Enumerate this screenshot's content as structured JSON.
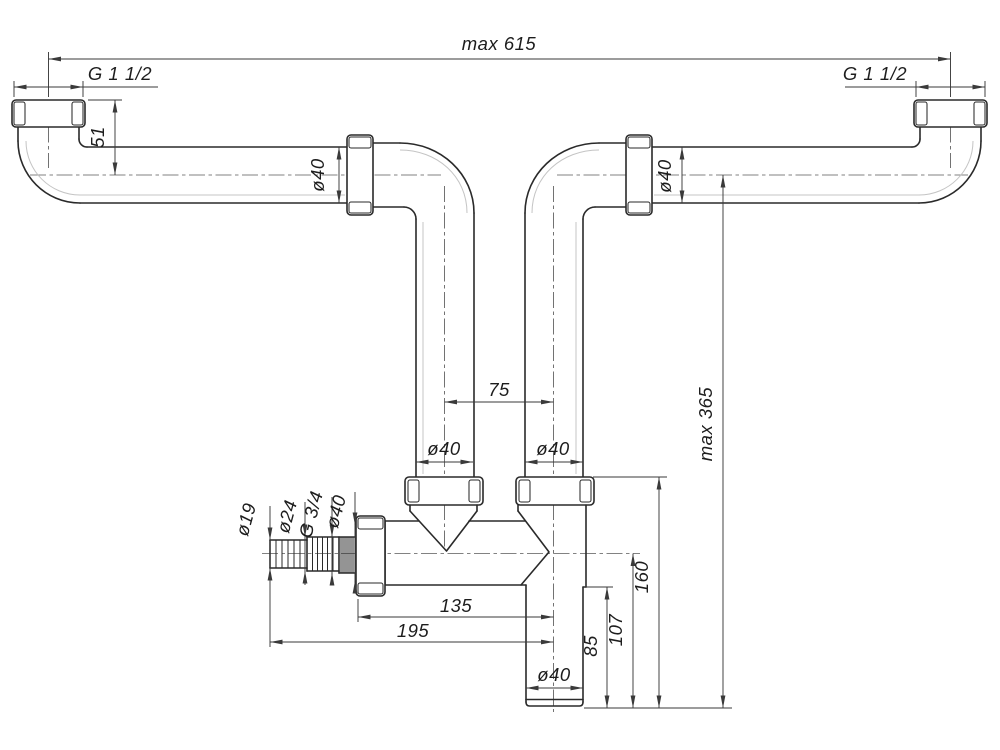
{
  "drawing": {
    "kind": "technical drawing — twin-inlet sink drain outlet pipe with hose branch",
    "background": "#ffffff",
    "line_color": "#2a2a2a",
    "dimension_color": "#3a3a3a",
    "centerline_color": "#5a5a5a",
    "labels": {
      "overall_width": "max 615",
      "overall_height": "max 365",
      "left_inlet_thread": "G 1 1/2",
      "right_inlet_thread": "G 1 1/2",
      "inlet_drop": "51",
      "left_pipe_dia": "ø40",
      "right_pipe_dia": "ø40",
      "riser_spacing": "75",
      "left_riser_dia": "ø40",
      "right_riser_dia": "ø40",
      "hose_barb_dia_small": "ø19",
      "hose_barb_dia_large": "ø24",
      "side_thread": "G 3/4",
      "side_union_dia": "ø40",
      "body_len_to_nut": "135",
      "body_len_to_tip": "195",
      "outlet_drop_from_body": "85",
      "outlet_drop_from_axis": "107",
      "outlet_drop_from_nut_top": "160",
      "outlet_dia": "ø40"
    }
  }
}
